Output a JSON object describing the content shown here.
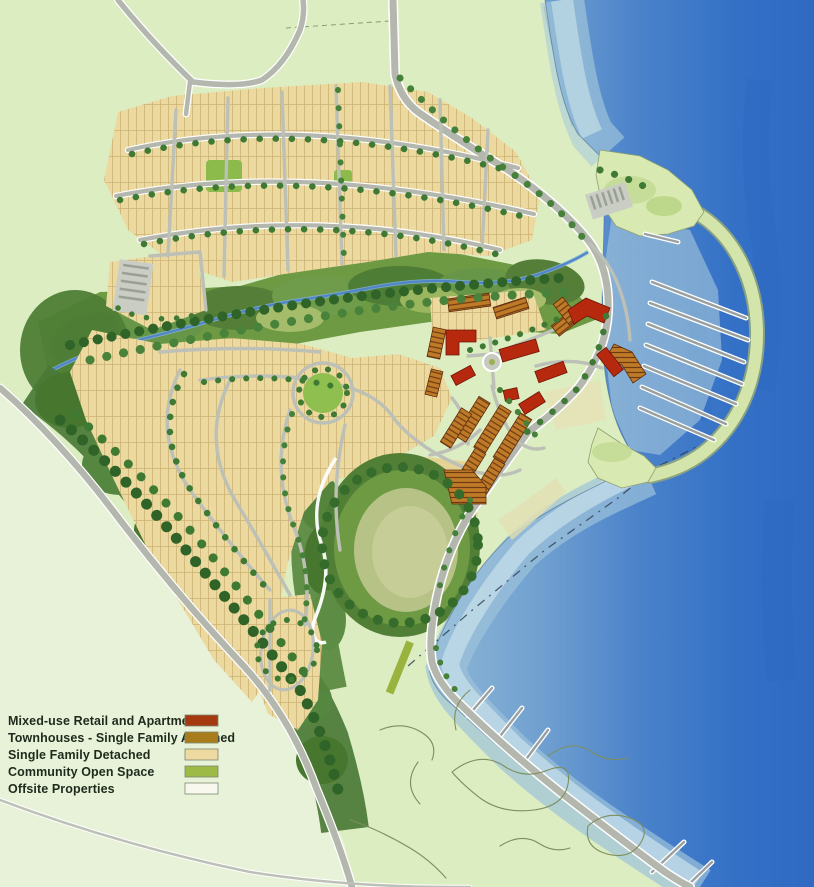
{
  "legend": {
    "items": [
      {
        "label": "Mixed-use Retail and Apartments",
        "color": "#a53a10"
      },
      {
        "label": "Townhouses - Single Family Attached",
        "color": "#a87b1b"
      },
      {
        "label": "Single Family Detached",
        "color": "#eed9a0"
      },
      {
        "label": "Community Open Space",
        "color": "#9cba45"
      },
      {
        "label": "Offsite Properties",
        "color": "#f8f8ee"
      }
    ]
  },
  "map": {
    "palette": {
      "water_deep": "#2f6ac2",
      "water_shallow": "#b4d2e2",
      "open_space_green": "#6e9a43",
      "offsite_green": "#dcedc2",
      "road_gray": "#b3b7ad"
    }
  }
}
